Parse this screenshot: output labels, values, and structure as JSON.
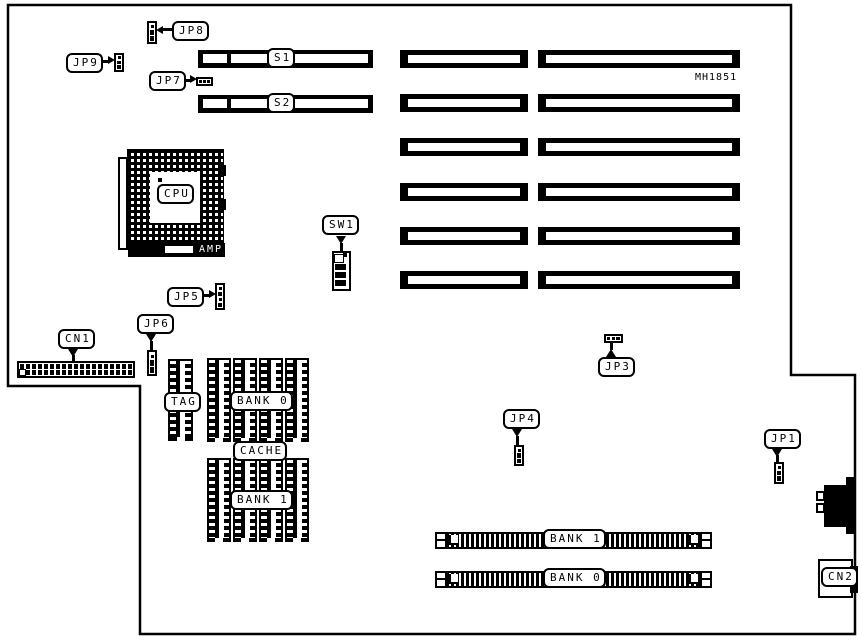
{
  "board": {
    "part_number": "MH1851",
    "labels": {
      "jp1": "JP1",
      "jp3": "JP3",
      "jp4": "JP4",
      "jp5": "JP5",
      "jp6": "JP6",
      "jp7": "JP7",
      "jp8": "JP8",
      "jp9": "JP9",
      "s1": "S1",
      "s2": "S2",
      "sw1": "SW1",
      "cn1": "CN1",
      "cn2": "CN2",
      "cpu": "CPU",
      "amp": "AMP",
      "tag": "TAG",
      "cache": "CACHE",
      "cache_bank_0": "BANK 0",
      "cache_bank_1": "BANK 1",
      "simm_bank_1": "BANK 1",
      "simm_bank_0": "BANK 0"
    },
    "colors": {
      "ink": "#000000",
      "background": "#ffffff"
    }
  }
}
